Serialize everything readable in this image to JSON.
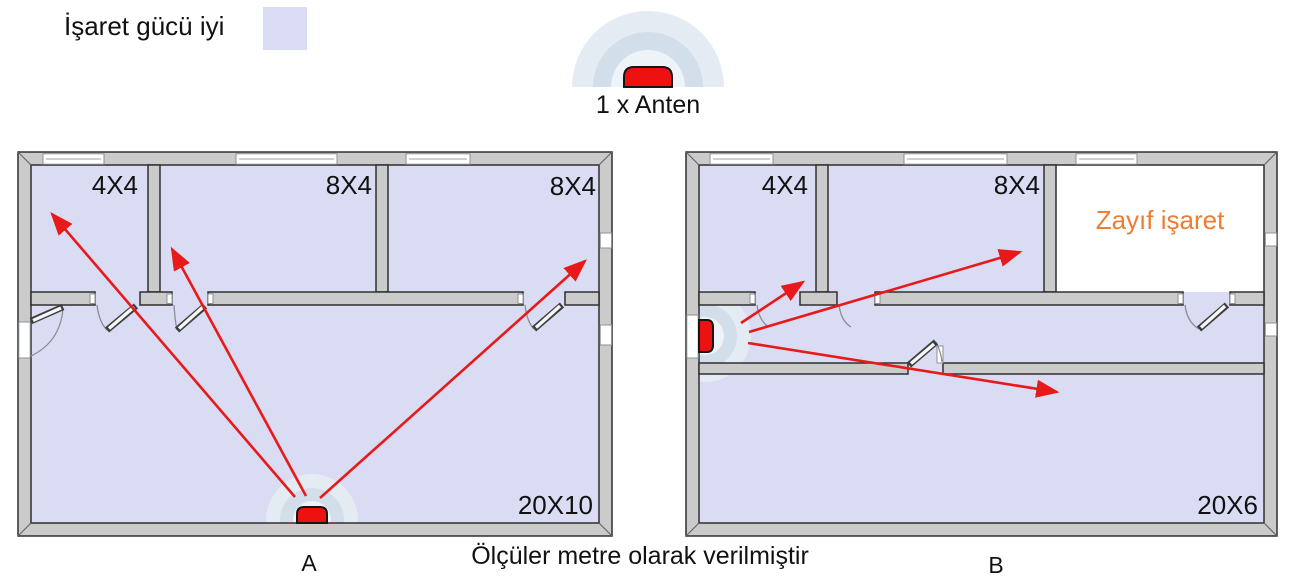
{
  "legend": {
    "label": "İşaret gücü iyi"
  },
  "antenna_legend": {
    "label": "1 x Anten"
  },
  "caption": "Ölçüler metre olarak verilmiştir",
  "plan_a": {
    "label": "A",
    "rooms": [
      {
        "label": "4X4"
      },
      {
        "label": "8X4"
      },
      {
        "label": "8X4"
      },
      {
        "label": "20X10"
      }
    ]
  },
  "plan_b": {
    "label": "B",
    "rooms": [
      {
        "label": "4X4"
      },
      {
        "label": "8X4"
      },
      {
        "label": "Zayıf işaret",
        "status": "weak-signal"
      },
      {
        "label": "20X6"
      }
    ]
  },
  "icons": {
    "antenna": "antenna-icon",
    "signal_waves": "signal-waves-icon",
    "coverage_arrow": "signal-arrow-icon"
  },
  "colors": {
    "signal_good_fill": "#dadcf4",
    "arrow_red": "#e81919",
    "antenna_red": "#ee1111",
    "weak_signal_text": "#ed7d31",
    "wall_fill": "#cbcbcb",
    "wall_outline": "#2f2f2f",
    "wave_outer": "#e4ebf2",
    "wave_mid": "#d2dfeb",
    "wave_inner": "#eef3f8"
  }
}
